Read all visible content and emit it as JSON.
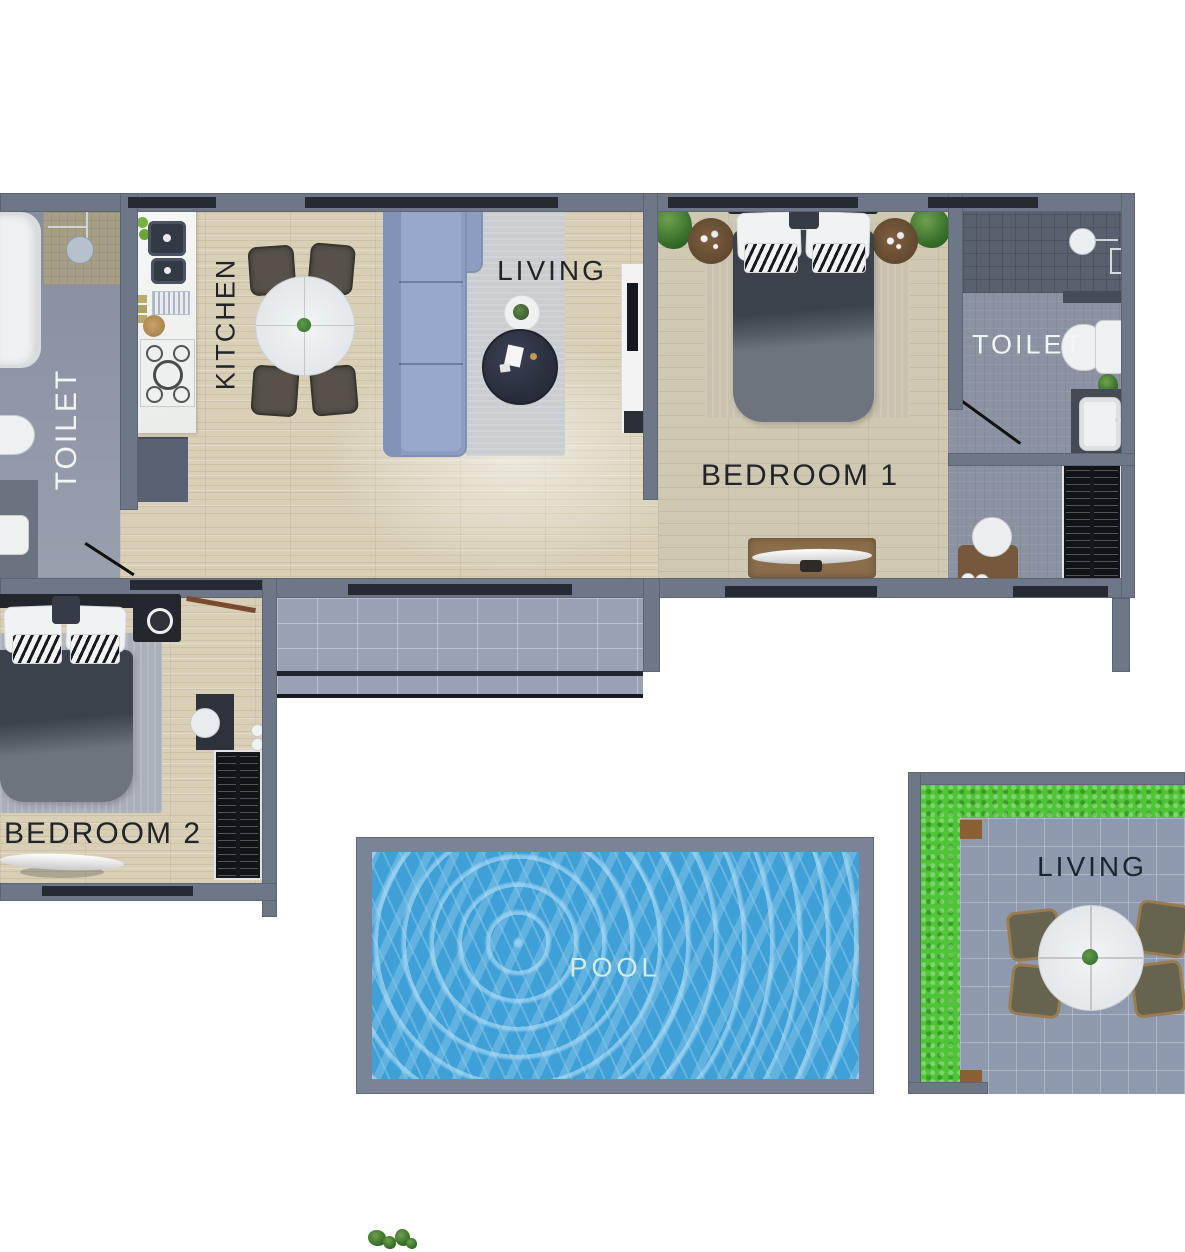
{
  "page": {
    "type": "apartment-floor-plan-render"
  },
  "labels": {
    "toilet_main": "TOILET",
    "kitchen": "KITCHEN",
    "living_indoor": "LIVING",
    "bedroom_1": "BEDROOM 1",
    "toilet_ensuite": "TOILET",
    "bedroom_2": "BEDROOM 2",
    "pool": "POOL",
    "living_outdoor": "LIVING"
  },
  "colors": {
    "wall": "#6e7787",
    "window_glass": "#262b33",
    "wood_floor": "#d8cfb6",
    "bathroom_tile": "#8b93a2",
    "deck_tile": "#99a2b4",
    "patio_tile": "#8e99ad",
    "grass": "#4fc437",
    "pool_water": "#3fa0d8",
    "sofa": "#8d9dc1",
    "bed_duvet": "#3c424c",
    "label_dark": "#22242a",
    "label_light": "#f3f5f5"
  }
}
